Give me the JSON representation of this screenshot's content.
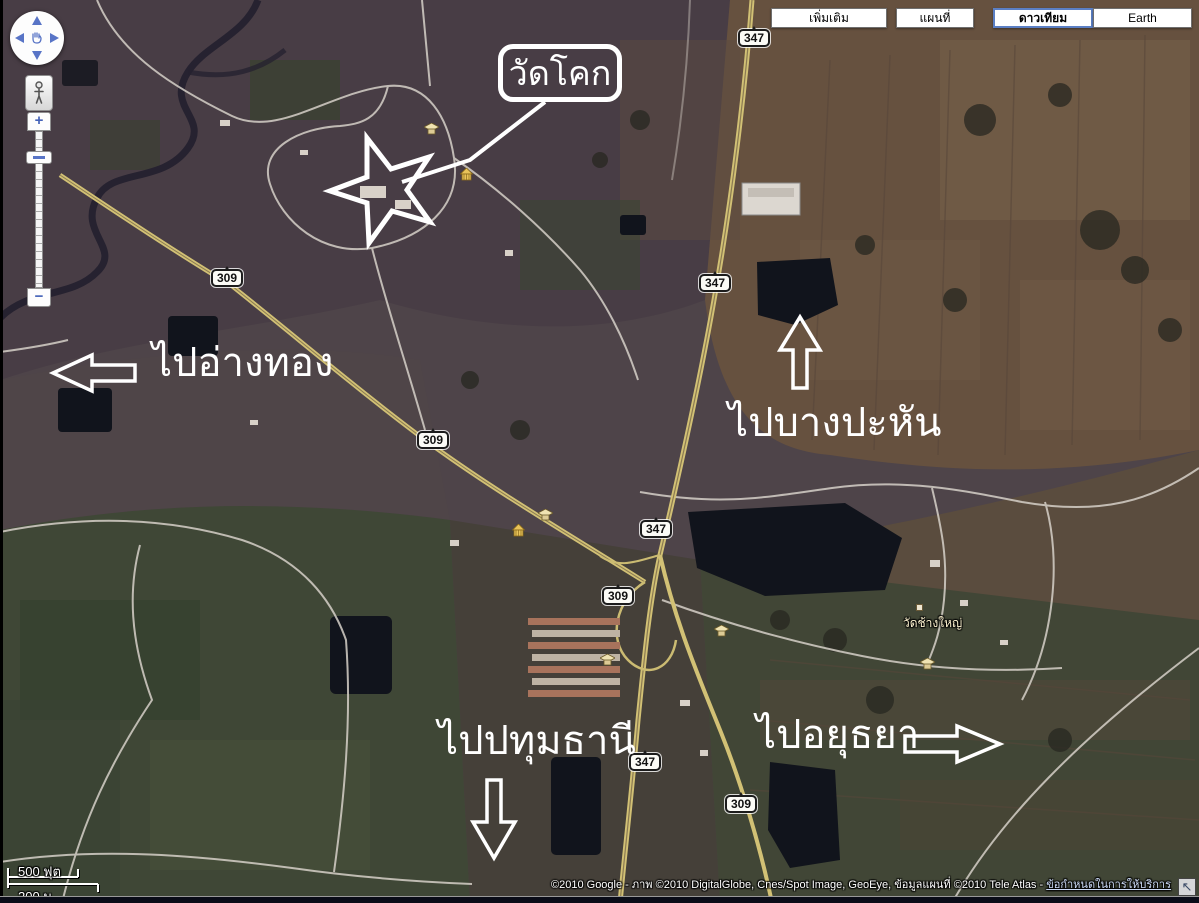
{
  "map_type_bar": {
    "buttons": [
      {
        "label": "เพิ่มเติม",
        "active": false
      },
      {
        "label": "แผนที่",
        "active": false
      },
      {
        "label": "ดาวเทียม",
        "active": true
      },
      {
        "label": "Earth",
        "active": false
      }
    ]
  },
  "controls": {
    "zoom_in_label": "+",
    "zoom_out_label": "−",
    "collapse_icon": "↖"
  },
  "annotations": {
    "callout": {
      "text": "วัดโคก"
    },
    "directions": [
      {
        "label": "ไปอ่างทอง",
        "direction": "left"
      },
      {
        "label": "ไปบางปะหัน",
        "direction": "up"
      },
      {
        "label": "ไปปทุมธานี",
        "direction": "down"
      },
      {
        "label": "ไปอยุธยา",
        "direction": "right"
      }
    ]
  },
  "road_shields": [
    {
      "number": "347"
    },
    {
      "number": "347"
    },
    {
      "number": "347"
    },
    {
      "number": "347"
    },
    {
      "number": "309"
    },
    {
      "number": "309"
    },
    {
      "number": "309"
    },
    {
      "number": "309"
    }
  ],
  "poi_labels": [
    {
      "text": "วัดช้างใหญ่"
    }
  ],
  "scale_bar": {
    "feet": "500 ฟุต",
    "meters": "200 ม."
  },
  "attribution": {
    "text": "©2010 Google - ภาพ ©2010 DigitalGlobe, Cnes/Spot Image, GeoEye, ข้อมูลแผนที่ ©2010 Tele Atlas - ",
    "terms_link": "ข้อกำหนดในการให้บริการ"
  },
  "colors": {
    "annotation_white": "#ffffff",
    "road_yellow": "#d2c175",
    "water_dark": "#11141c",
    "control_blue": "#5874c6",
    "active_button_border": "#5b7fc4"
  }
}
